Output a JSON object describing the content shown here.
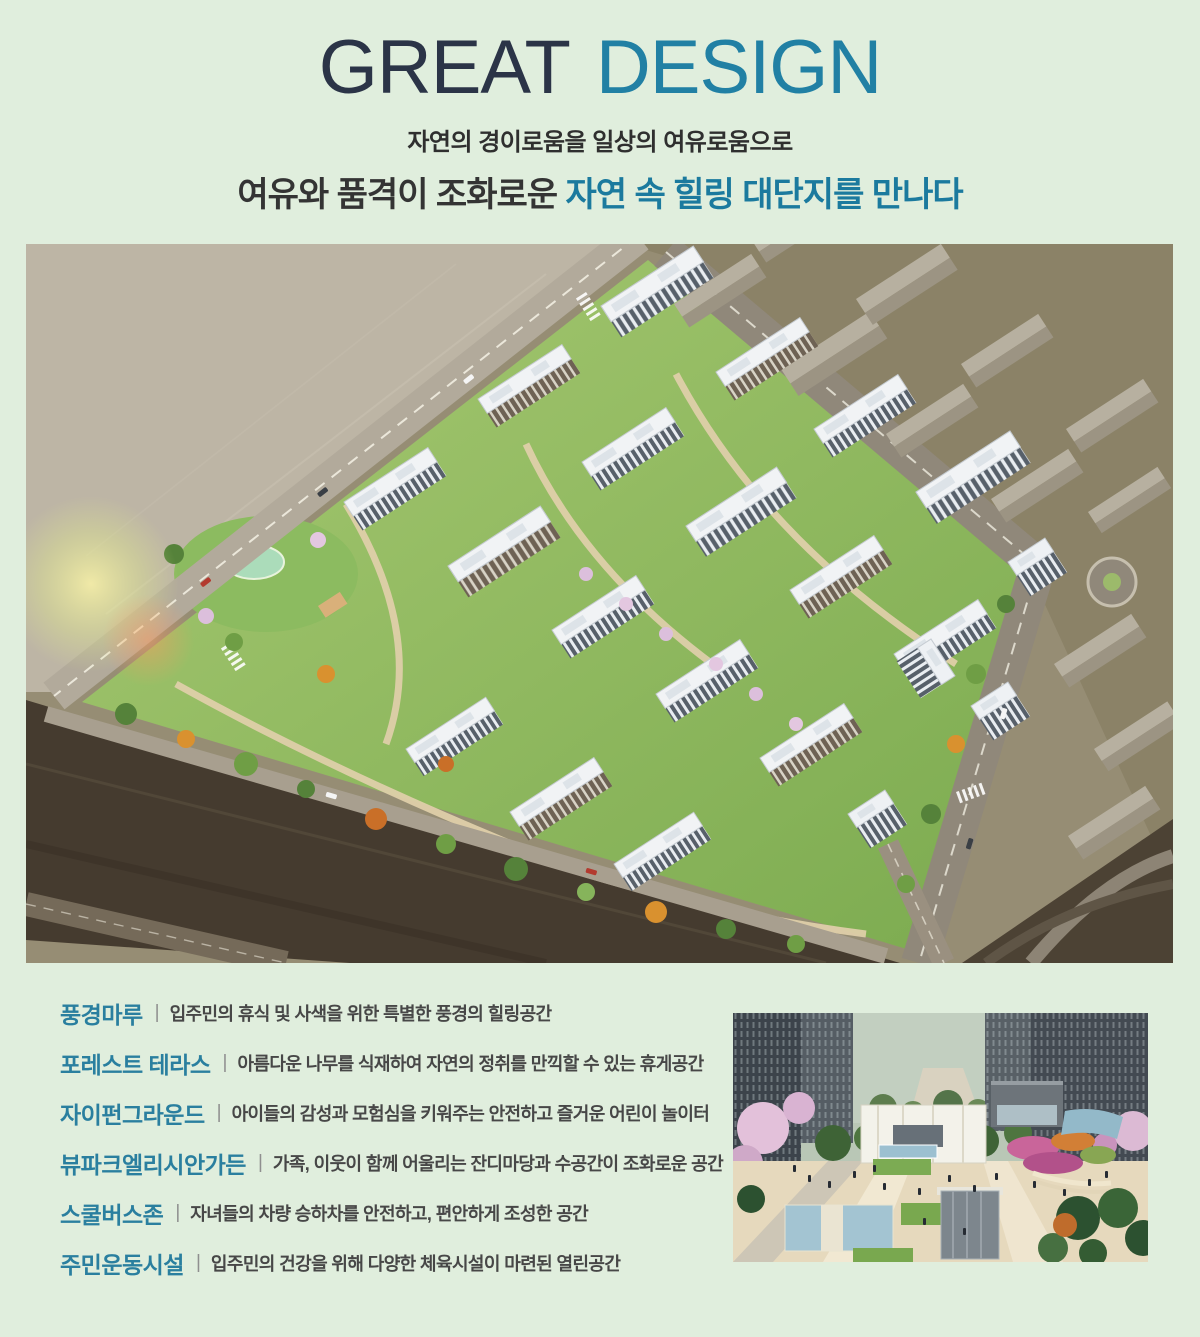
{
  "colors": {
    "page_background": "#e0eedd",
    "title_dark": "#2b3447",
    "title_accent": "#2180a4",
    "headline_accent": "#1b7a9e",
    "feature_label": "#2a7f9f",
    "body_text": "#474747"
  },
  "header": {
    "title_part1": "GREAT",
    "title_part2": "DESIGN",
    "subtitle": "자연의 경이로움을 일상의 여유로움으로",
    "headline_prefix": "여유와 품격이 조화로운 ",
    "headline_accent": "자연 속 힐링 대단지를 만나다"
  },
  "feature_divider": "|",
  "features": [
    {
      "label": "풍경마루",
      "description": "입주민의 휴식 및 사색을 위한 특별한 풍경의 힐링공간"
    },
    {
      "label": "포레스트 테라스",
      "description": "아름다운 나무를 식재하여 자연의 정취를 만끽할 수 있는 휴게공간"
    },
    {
      "label": "자이펀그라운드",
      "description": "아이들의 감성과 모험심을 키워주는 안전하고 즐거운 어린이 놀이터"
    },
    {
      "label": "뷰파크엘리시안가든",
      "description": "가족, 이웃이 함께 어울리는 잔디마당과 수공간이 조화로운 공간"
    },
    {
      "label": "스쿨버스존",
      "description": "자녀들의 차량 승하차를 안전하고, 편안하게 조성한 공간"
    },
    {
      "label": "주민운동시설",
      "description": "입주민의 건강을 위해 다양한 체육시설이 마련된 열린공간"
    }
  ]
}
